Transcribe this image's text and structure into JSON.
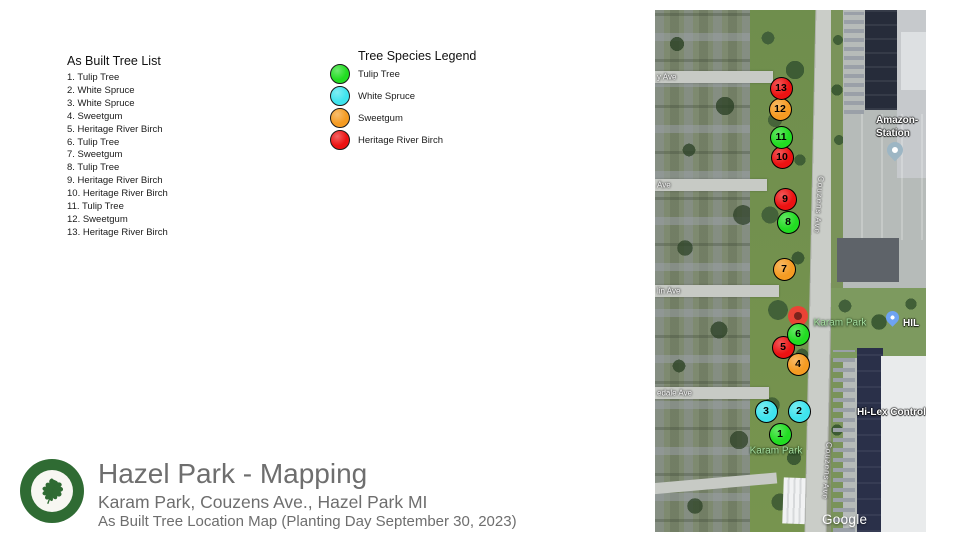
{
  "tree_list": {
    "title": "As Built Tree List",
    "items": [
      "1. Tulip Tree",
      "2. White Spruce",
      "3. White Spruce",
      "4. Sweetgum",
      "5. Heritage River Birch",
      "6. Tulip Tree",
      "7. Sweetgum",
      "8. Tulip Tree",
      "9. Heritage River Birch",
      "10. Heritage River Birch",
      "11. Tulip Tree",
      "12. Sweetgum",
      "13. Heritage River Birch"
    ]
  },
  "legend": {
    "title": "Tree Species Legend",
    "entries": [
      {
        "label": "Tulip Tree",
        "color": "#22DD22"
      },
      {
        "label": "White Spruce",
        "color": "#3FE4EE"
      },
      {
        "label": "Sweetgum",
        "color": "#F59B22"
      },
      {
        "label": "Heritage River Birch",
        "color": "#EC1212"
      }
    ]
  },
  "footer": {
    "title": "Hazel Park - Mapping",
    "subtitle": "Karam Park, Couzens Ave., Hazel Park MI",
    "description": "As Built Tree Location Map (Planting Day September 30, 2023)"
  },
  "map": {
    "markers": [
      {
        "num": "1",
        "species": "Tulip Tree",
        "color": "#22DD22",
        "x": 125,
        "y": 424
      },
      {
        "num": "2",
        "species": "White Spruce",
        "color": "#3FE4EE",
        "x": 144,
        "y": 401
      },
      {
        "num": "3",
        "species": "White Spruce",
        "color": "#3FE4EE",
        "x": 111,
        "y": 401
      },
      {
        "num": "4",
        "species": "Sweetgum",
        "color": "#F59B22",
        "x": 143,
        "y": 354
      },
      {
        "num": "5",
        "species": "Heritage River Birch",
        "color": "#EC1212",
        "x": 128,
        "y": 337
      },
      {
        "num": "6",
        "species": "Tulip Tree",
        "color": "#22DD22",
        "x": 143,
        "y": 324
      },
      {
        "num": "7",
        "species": "Sweetgum",
        "color": "#F59B22",
        "x": 129,
        "y": 259
      },
      {
        "num": "8",
        "species": "Tulip Tree",
        "color": "#22DD22",
        "x": 133,
        "y": 212
      },
      {
        "num": "9",
        "species": "Heritage River Birch",
        "color": "#EC1212",
        "x": 130,
        "y": 189
      },
      {
        "num": "10",
        "species": "Heritage River Birch",
        "color": "#EC1212",
        "x": 127,
        "y": 147
      },
      {
        "num": "11",
        "species": "Tulip Tree",
        "color": "#22DD22",
        "x": 126,
        "y": 127
      },
      {
        "num": "12",
        "species": "Sweetgum",
        "color": "#F59B22",
        "x": 125,
        "y": 99
      },
      {
        "num": "13",
        "species": "Heritage River Birch",
        "color": "#EC1212",
        "x": 126,
        "y": 78
      }
    ],
    "street_labels": [
      {
        "text": "y Ave",
        "x": 2,
        "y": 67
      },
      {
        "text": "Ave",
        "x": 2,
        "y": 175
      },
      {
        "text": "lin Ave",
        "x": 2,
        "y": 281
      },
      {
        "text": "edale Ave",
        "x": 2,
        "y": 383
      }
    ],
    "road_labels": [
      {
        "text": "Couzens Ave",
        "x": 164,
        "y": 195
      },
      {
        "text": "Couzens Ave",
        "x": 172,
        "y": 461
      }
    ],
    "park_labels": [
      {
        "text": "Karam Park",
        "x": 185,
        "y": 313
      },
      {
        "text": "Karam Park",
        "x": 121,
        "y": 441
      }
    ],
    "poi": {
      "amazon_line1": "Amazon-",
      "amazon_line2": "Station",
      "hi_lex_pin_label": "HIL",
      "hi_lex_building_label": "Hi-Lex Control"
    },
    "attribution": "Google"
  }
}
